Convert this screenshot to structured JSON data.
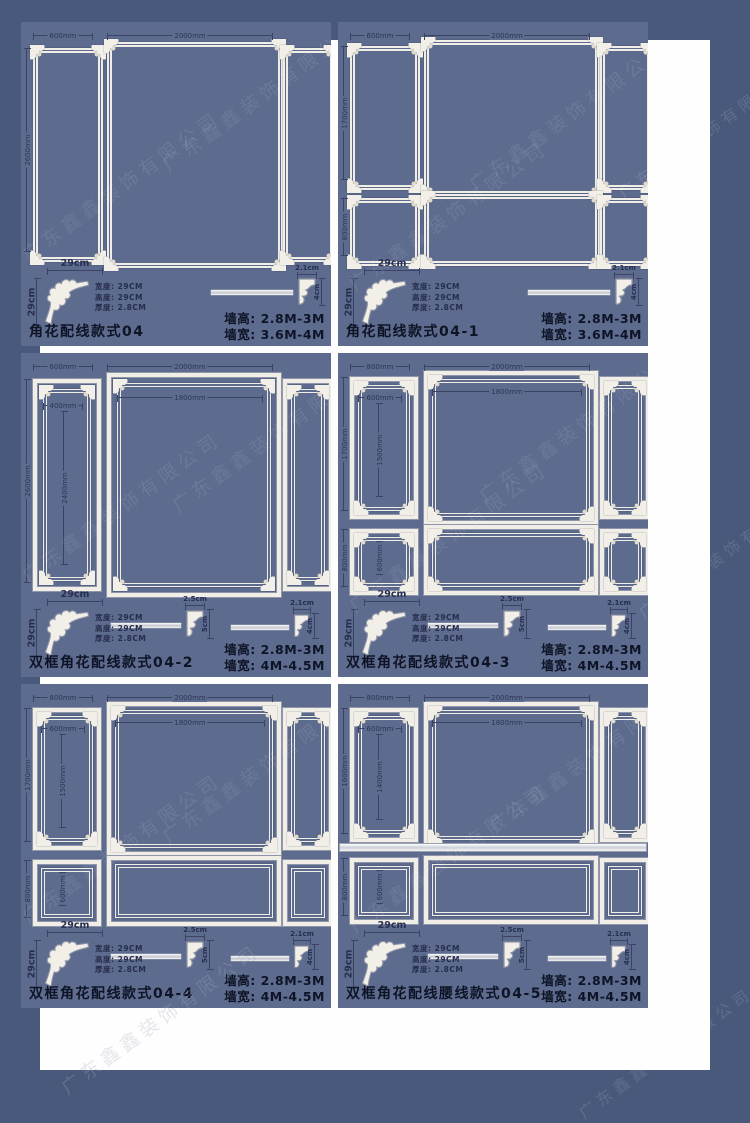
{
  "watermark": "广东鑫鑫装饰有限公司",
  "colors": {
    "outer_border": "#49597b",
    "mat": "#fefefe",
    "panel_background": "#5d6b8e",
    "molding_white": "#f1eee7",
    "dimension_text": "#2d3558",
    "title_text": "#0e1426"
  },
  "molding": {
    "width_label": "29cm",
    "height_label": "29cm",
    "spec_width": "宽度: 29CM",
    "spec_height": "高度: 29CM",
    "spec_thickness": "厚度: 2.8CM"
  },
  "panels": [
    {
      "title": "角花配线款式04",
      "wall_height": "墙高: 2.8M-3M",
      "wall_width": "墙宽: 3.6M-4M",
      "dims": {
        "left_width": "600mm",
        "center_width": "2000mm",
        "left_height": "2600mm"
      },
      "profiles": [
        {
          "width": "2.1cm",
          "height": "4cm"
        }
      ]
    },
    {
      "title": "角花配线款式04-1",
      "wall_height": "墙高: 2.8M-3M",
      "wall_width": "墙宽: 3.6M-4M",
      "dims": {
        "left_width": "600mm",
        "center_width": "2000mm",
        "left_height": "1700mm",
        "bottom_left_height": "800mm"
      },
      "profiles": [
        {
          "width": "2.1cm",
          "height": "4cm"
        }
      ]
    },
    {
      "title": "双框角花配线款式04-2",
      "wall_height": "墙高: 2.8M-3M",
      "wall_width": "墙宽: 4M-4.5M",
      "dims": {
        "left_width": "600mm",
        "left_inner_width": "400mm",
        "center_width": "2000mm",
        "center_inner_width": "1800mm",
        "left_height": "2600mm",
        "left_inner_height": "2400mm"
      },
      "profiles": [
        {
          "width": "2.5cm",
          "height": "5cm"
        },
        {
          "width": "2.1cm",
          "height": "4cm"
        }
      ]
    },
    {
      "title": "双框角花配线款式04-3",
      "wall_height": "墙高: 2.8M-3M",
      "wall_width": "墙宽: 4M-4.5M",
      "dims": {
        "left_width": "800mm",
        "left_inner_width": "600mm",
        "center_width": "2000mm",
        "center_inner_width": "1800mm",
        "left_height": "1700mm",
        "left_inner_height": "1500mm",
        "bottom_left_height": "800mm",
        "bottom_left_inner_height": "600mm"
      },
      "profiles": [
        {
          "width": "2.5cm",
          "height": "5cm"
        },
        {
          "width": "2.1cm",
          "height": "4cm"
        }
      ]
    },
    {
      "title": "双框角花配线款式04-4",
      "wall_height": "墙高: 2.8M-3M",
      "wall_width": "墙宽: 4M-4.5M",
      "dims": {
        "left_width": "800mm",
        "left_inner_width": "600mm",
        "center_width": "2000mm",
        "center_inner_width": "1800mm",
        "left_height": "1700mm",
        "left_inner_height": "1500mm",
        "bottom_left_height": "800mm",
        "bottom_left_inner_height": "600mm"
      },
      "profiles": [
        {
          "width": "2.5cm",
          "height": "5cm"
        },
        {
          "width": "2.1cm",
          "height": "4cm"
        }
      ]
    },
    {
      "title": "双框角花配线腰线款式04-5",
      "wall_height": "墙高: 2.8M-3M",
      "wall_width": "墙宽: 4M-4.5M",
      "dims": {
        "left_width": "800mm",
        "left_inner_width": "600mm",
        "center_width": "2000mm",
        "center_inner_width": "1800mm",
        "left_height": "1600mm",
        "left_inner_height": "1400mm",
        "bottom_left_height": "800mm",
        "bottom_left_inner_height": "600mm"
      },
      "profiles": [
        {
          "width": "2.5cm",
          "height": "5cm"
        },
        {
          "width": "2.1cm",
          "height": "4cm"
        }
      ]
    }
  ]
}
